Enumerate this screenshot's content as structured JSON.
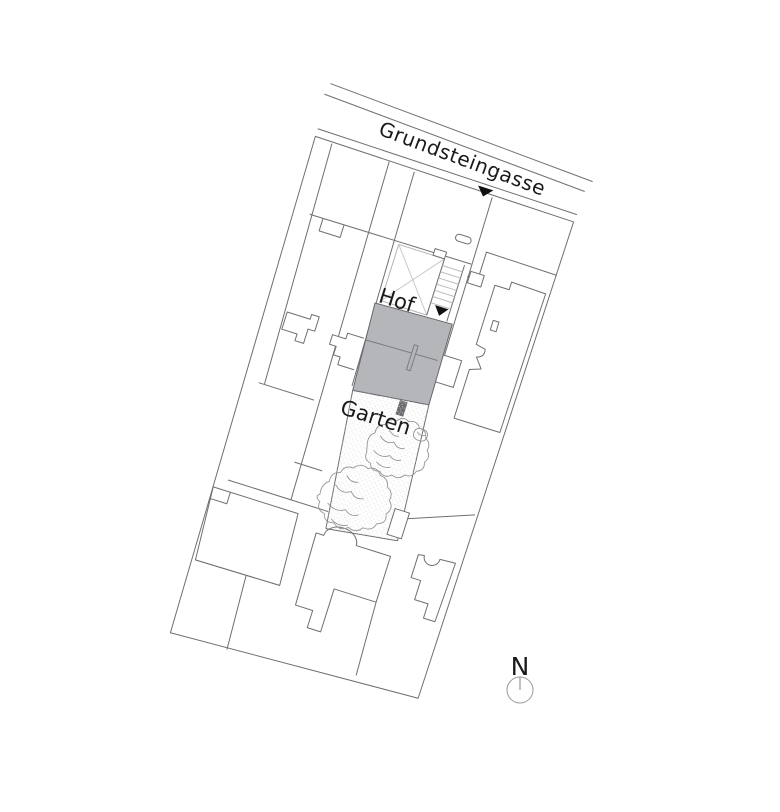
{
  "plan": {
    "street_label": "Grundsteingasse",
    "courtyard_label": "Hof",
    "garden_label": "Garten",
    "north_label": "N"
  },
  "icons": {
    "entrance_arrow": "filled-triangle-down",
    "north_indicator": "compass-circle-with-needle"
  },
  "colors": {
    "line": "#6f6f73",
    "light_line": "#bcbcc0",
    "cross_line": "#c9c9cd",
    "building_fill": "#b5b6ba",
    "building_stroke": "#66676b",
    "divider_line": "#7c7d81",
    "marker_fill": "#6b6c70",
    "arrow": "#111111",
    "text": "#1a1a1a",
    "north_stroke": "#9a9a9e",
    "stipple_dot": "#d9d9db"
  }
}
